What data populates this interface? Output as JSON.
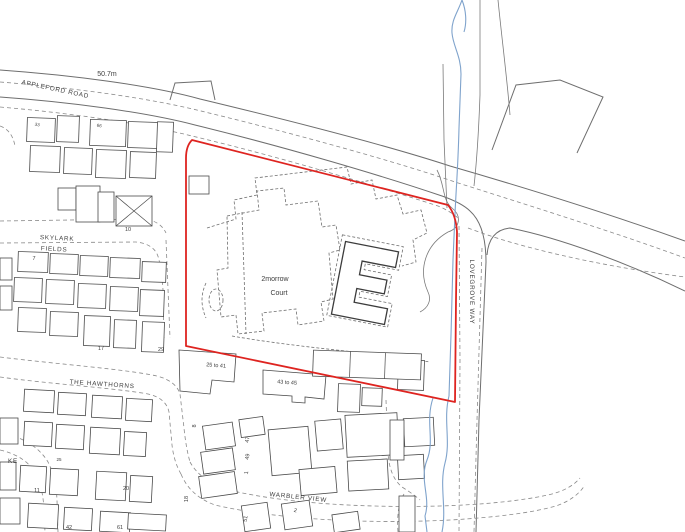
{
  "map": {
    "colors": {
      "boundary_red": "#de2420",
      "water_blue": "#7fa3cc",
      "road_grey": "#6e6e6e",
      "spot_height_red": "#c0504d",
      "label_grey": "#3d3d3d"
    },
    "labels": {
      "spot_height": "50.7m",
      "appleford_road": "APPLEFORD ROAD",
      "skylark_line1": "SKYLARK",
      "skylark_line2": "FIELDS",
      "the_hawthorns": "THE HAWTHORNS",
      "warbler_view": "WARBLER VIEW",
      "lovegrove_way": "LOVEGROVE WAY",
      "court_line1": "2morrow",
      "court_line2": "Court",
      "range_25_41": "25 to 41",
      "range_43_45": "43 to 45",
      "partial_street": "KE",
      "n7": "7",
      "n10": "10",
      "n17": "17",
      "n29": "29",
      "n33": "33",
      "n66": "66",
      "n8": "8",
      "n47": "47",
      "n49": "49",
      "n1": "1",
      "n18": "18",
      "n20": "20",
      "n11": "11",
      "n25": "25",
      "n42": "42",
      "n61": "61",
      "n51": "51",
      "n2": "2"
    }
  }
}
